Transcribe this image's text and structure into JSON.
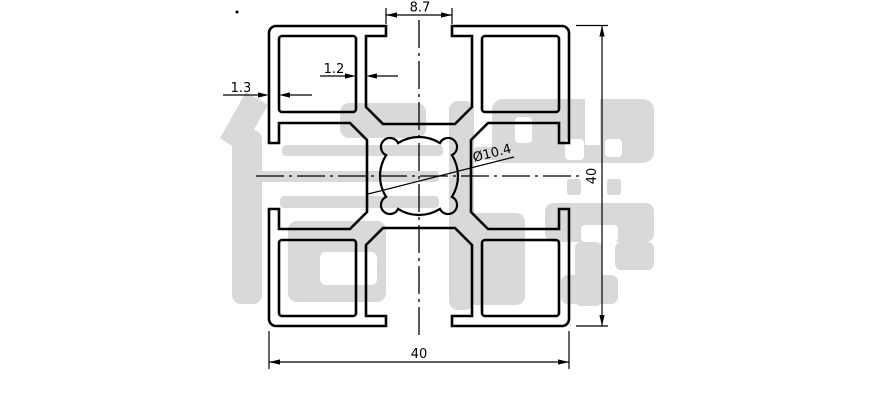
{
  "page": {
    "background": "#ffffff",
    "description": "CAD cross-section drawing of a 40x40 aluminium extrusion profile"
  },
  "drawing": {
    "stroke_color": "#000000",
    "dimensions": {
      "slot_opening": "8.7",
      "inner_wall_thickness": "1.2",
      "outer_wall_thickness": "1.3",
      "center_bore_diameter": "Ø10.4",
      "overall_height": "40",
      "overall_width": "40"
    },
    "watermark": {
      "text": "信牌",
      "color": "#d9d9d9"
    }
  }
}
